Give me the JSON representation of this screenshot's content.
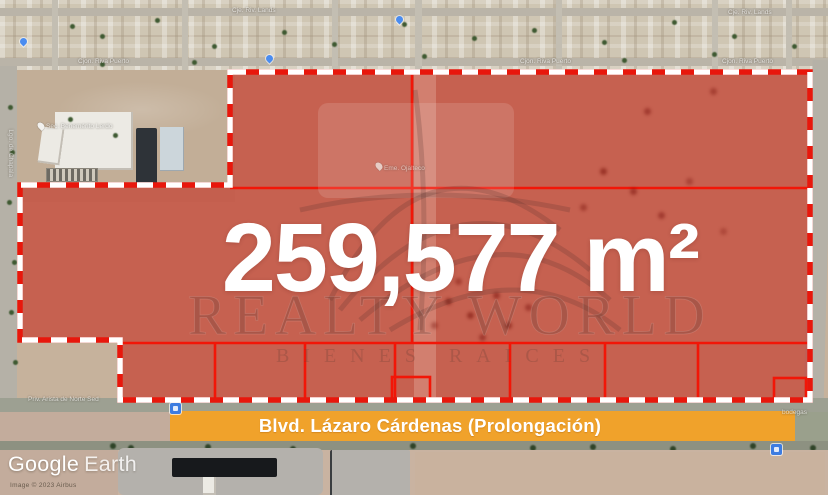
{
  "parcel": {
    "area_label": "259,577 m²",
    "fill_color": "#c7261a",
    "line_color": "#f21607",
    "outline_dash_color": "#ffffff"
  },
  "banner": {
    "label": "Blvd. Lázaro Cárdenas (Prolongación)",
    "bg_color": "#f0a22b",
    "text_color": "#ffffff"
  },
  "watermark": {
    "brand": "REALTY WORLD",
    "tagline": "BIENES RAICES"
  },
  "attribution": {
    "logo_primary": "Google",
    "logo_secondary": "Earth",
    "imagery_credit": "Image © 2023 Airbus"
  },
  "labels": {
    "streets": [
      {
        "text": "Cje. Riv. Lands"
      },
      {
        "text": "Cje. Riv. Lands"
      },
      {
        "text": "Cjon. Riva Puerto"
      },
      {
        "text": "Cjon. Riva Puerto"
      },
      {
        "text": "Cjon. Riva Puerto"
      },
      {
        "text": "Lgo. de Chapala"
      },
      {
        "text": "Priv. Arista de Norte Sed"
      },
      {
        "text": "bodegas"
      }
    ],
    "places": [
      {
        "text": "Sec. Benemérito Lerdo"
      },
      {
        "text": "Eme. Ojalteco"
      }
    ]
  }
}
